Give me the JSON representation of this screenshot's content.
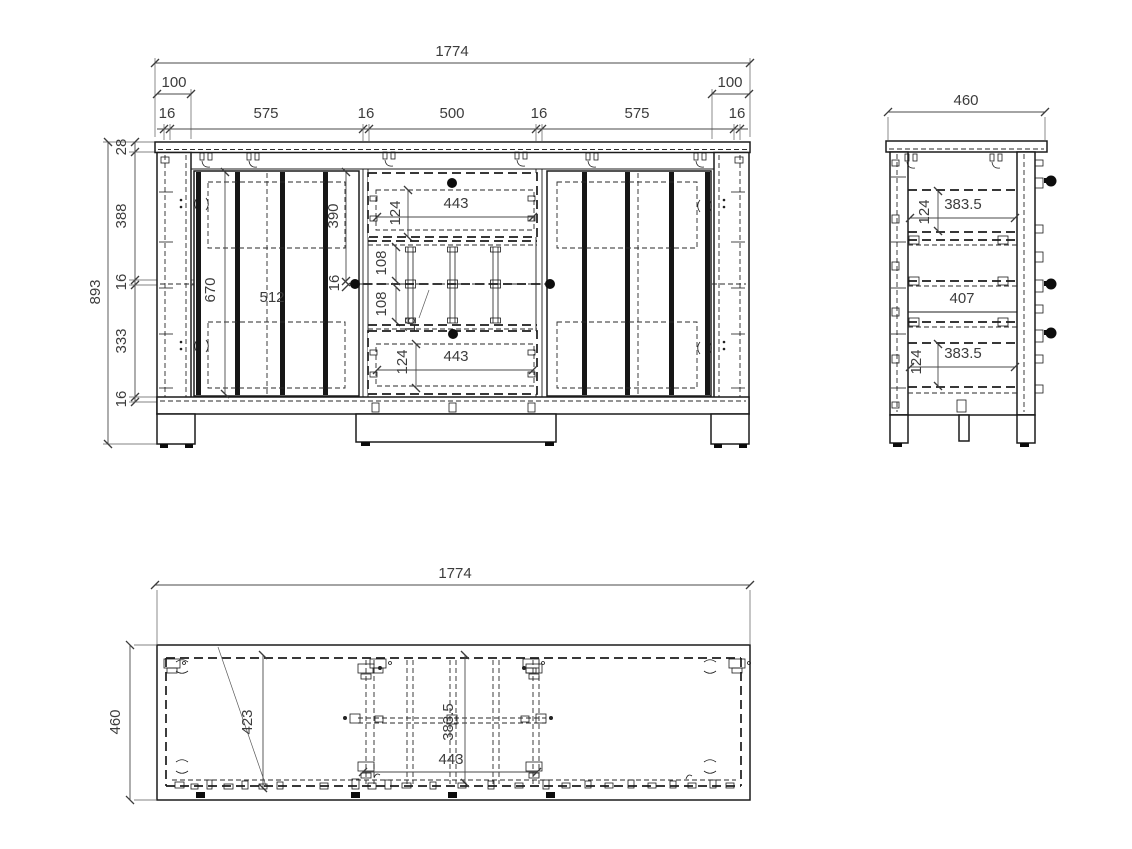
{
  "front": {
    "width_total": "1774",
    "overhang_left": "100",
    "overhang_right": "100",
    "width_chain": [
      "16",
      "575",
      "16",
      "500",
      "16",
      "575",
      "16"
    ],
    "height_total": "893",
    "height_chain": [
      "28",
      "388",
      "16",
      "333",
      "16"
    ],
    "door_panel_height": "670",
    "door_panel_width": "512",
    "door_upper_section": "390",
    "mid_shelf_thickness": "16",
    "rack_opening_upper": "108",
    "rack_opening_lower": "108",
    "rack_divider_thickness": "16",
    "drawer_top": {
      "width": "443",
      "height": "124"
    },
    "drawer_bottom": {
      "width": "443",
      "height": "124"
    }
  },
  "side": {
    "depth_total": "460",
    "drawer_top": {
      "depth": "383.5",
      "height": "124"
    },
    "middle_clearance": "407",
    "drawer_bottom": {
      "depth": "383.5",
      "height": "124"
    }
  },
  "top": {
    "width_total": "1774",
    "depth_total": "460",
    "door_panel": "423",
    "drawer_depth": "383.5",
    "drawer_width": "443"
  },
  "colors": {
    "line": "#1c1c1c",
    "dim_text": "#3c3c3c",
    "background": "#ffffff",
    "knob": "#0d0d0d"
  }
}
